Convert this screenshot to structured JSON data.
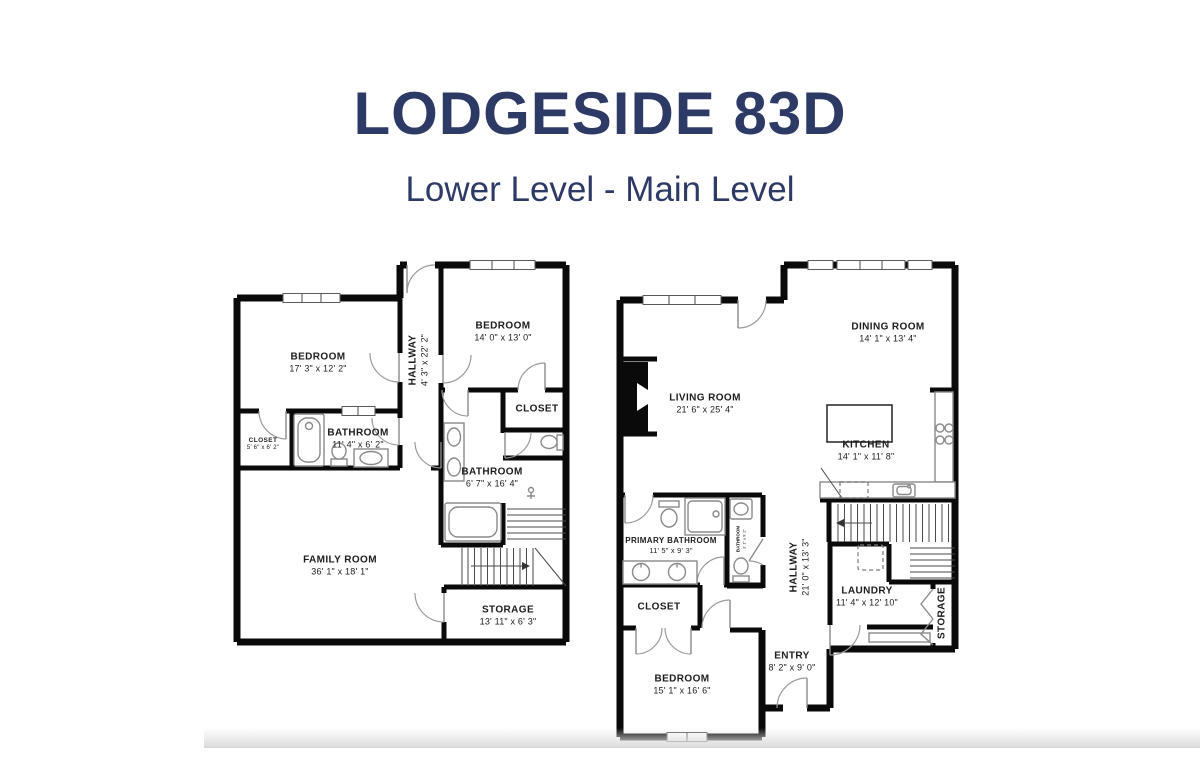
{
  "header": {
    "title": "LODGESIDE 83D",
    "subtitle": "Lower Level - Main Level"
  },
  "colors": {
    "accent": "#2e3a66",
    "walls": "#0a0a0a",
    "fixtures": "#8a8a8a"
  },
  "lower_level": {
    "rooms": [
      {
        "label": "BEDROOM",
        "dims": "17' 3\" x 12' 2\""
      },
      {
        "label": "BEDROOM",
        "dims": "14' 0\" x 13' 0\""
      },
      {
        "label": "HALLWAY",
        "dims": "4' 3\" x 22' 2\""
      },
      {
        "label": "CLOSET",
        "dims": "5' 6\" x 6' 2\""
      },
      {
        "label": "BATHROOM",
        "dims": "11' 4\" x 6' 2\""
      },
      {
        "label": "CLOSET",
        "dims": ""
      },
      {
        "label": "BATHROOM",
        "dims": "6' 7\" x 16' 4\""
      },
      {
        "label": "FAMILY ROOM",
        "dims": "36' 1\" x 18' 1\""
      },
      {
        "label": "STORAGE",
        "dims": "13' 11\" x 6' 3\""
      }
    ]
  },
  "main_level": {
    "rooms": [
      {
        "label": "DINING ROOM",
        "dims": "14' 1\" x 13' 4\""
      },
      {
        "label": "LIVING ROOM",
        "dims": "21' 6\" x 25' 4\""
      },
      {
        "label": "KITCHEN",
        "dims": "14' 1\" x 11' 8\""
      },
      {
        "label": "PRIMARY BATHROOM",
        "dims": "11' 5\" x 9' 3\""
      },
      {
        "label": "BATHROOM",
        "dims": "3' 1\" x 9' 2\""
      },
      {
        "label": "HALLWAY",
        "dims": "21' 0\" x 13' 3\""
      },
      {
        "label": "LAUNDRY",
        "dims": "11' 4\" x 12' 10\""
      },
      {
        "label": "STORAGE",
        "dims": ""
      },
      {
        "label": "CLOSET",
        "dims": ""
      },
      {
        "label": "ENTRY",
        "dims": "8' 2\" x 9' 0\""
      },
      {
        "label": "BEDROOM",
        "dims": "15' 1\" x 16' 6\""
      }
    ]
  }
}
